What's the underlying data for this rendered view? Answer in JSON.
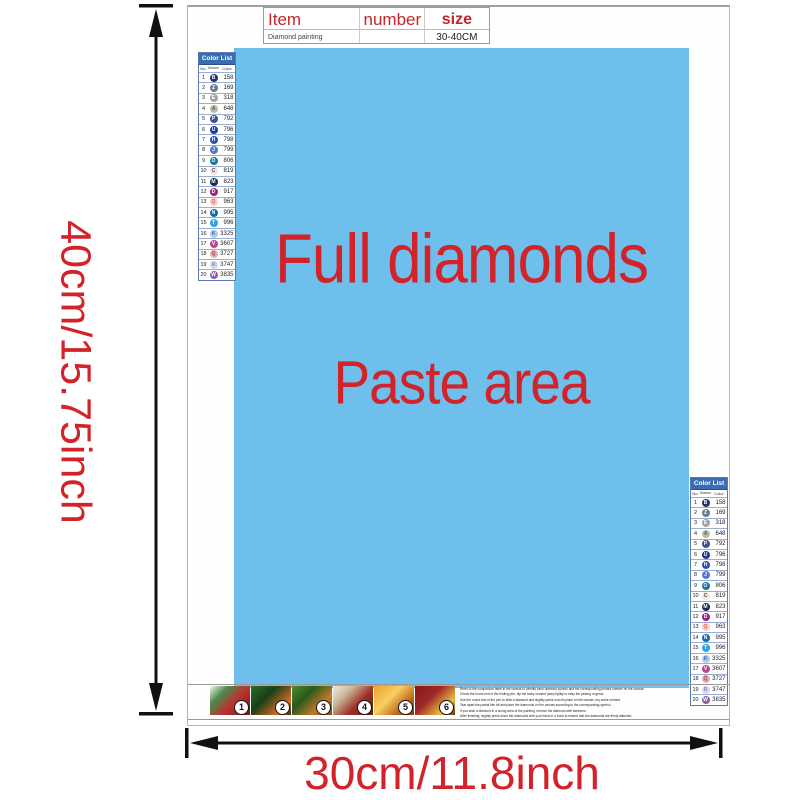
{
  "colors": {
    "accent_red": "#d2232a",
    "paste_blue": "#6fbfec",
    "table_header_blue": "#3a6cb4"
  },
  "dimensions": {
    "height_label": "40cm/15.75inch",
    "width_label": "30cm/11.8inch"
  },
  "spec_table": {
    "headers": [
      "Item",
      "number",
      "size"
    ],
    "row": {
      "item": "Diamond painting",
      "number": "",
      "size": "30-40CM"
    }
  },
  "paste_area": {
    "line1": "Full diamonds",
    "line2": "Paste area"
  },
  "color_list": {
    "title": "Color List",
    "columns": [
      "No.",
      "Diamond",
      "Color"
    ],
    "rows": [
      {
        "no": "1",
        "symbol": "B",
        "code": "158",
        "bg": "#2a2f68",
        "fg": "#ffffff"
      },
      {
        "no": "2",
        "symbol": "Z",
        "code": "169",
        "bg": "#6b7b8c",
        "fg": "#ffffff"
      },
      {
        "no": "3",
        "symbol": "E",
        "code": "318",
        "bg": "#a2a2a2",
        "fg": "#ffffff"
      },
      {
        "no": "4",
        "symbol": "4",
        "code": "648",
        "bg": "#beb8a8",
        "fg": "#555555"
      },
      {
        "no": "5",
        "symbol": "P",
        "code": "792",
        "bg": "#3d4e91",
        "fg": "#ffffff"
      },
      {
        "no": "6",
        "symbol": "U",
        "code": "796",
        "bg": "#21399b",
        "fg": "#ffffff"
      },
      {
        "no": "7",
        "symbol": "H",
        "code": "798",
        "bg": "#2c52b0",
        "fg": "#ffffff"
      },
      {
        "no": "8",
        "symbol": "J",
        "code": "799",
        "bg": "#5677c9",
        "fg": "#ffffff"
      },
      {
        "no": "9",
        "symbol": "O",
        "code": "806",
        "bg": "#1378a0",
        "fg": "#ffffff"
      },
      {
        "no": "10",
        "symbol": "C",
        "code": "819",
        "bg": "#f6e3e0",
        "fg": "#555555"
      },
      {
        "no": "11",
        "symbol": "M",
        "code": "823",
        "bg": "#1a2a52",
        "fg": "#ffffff"
      },
      {
        "no": "12",
        "symbol": "D",
        "code": "917",
        "bg": "#9e2283",
        "fg": "#ffffff"
      },
      {
        "no": "13",
        "symbol": "Q",
        "code": "963",
        "bg": "#f6cfc9",
        "fg": "#d2704f"
      },
      {
        "no": "14",
        "symbol": "N",
        "code": "995",
        "bg": "#0a6cb5",
        "fg": "#ffffff"
      },
      {
        "no": "15",
        "symbol": "T",
        "code": "996",
        "bg": "#2fa3e0",
        "fg": "#ffffff"
      },
      {
        "no": "16",
        "symbol": "K",
        "code": "3325",
        "bg": "#aecbe8",
        "fg": "#3a6fb0"
      },
      {
        "no": "17",
        "symbol": "V",
        "code": "3607",
        "bg": "#bd4594",
        "fg": "#ffffff"
      },
      {
        "no": "18",
        "symbol": "Q",
        "code": "3727",
        "bg": "#ddb0ba",
        "fg": "#b04040"
      },
      {
        "no": "19",
        "symbol": "R",
        "code": "3747",
        "bg": "#d7d5ee",
        "fg": "#8a8ab0"
      },
      {
        "no": "20",
        "symbol": "W",
        "code": "3835",
        "bg": "#8a62a0",
        "fg": "#ffffff"
      }
    ]
  },
  "steps": [
    {
      "n": "1"
    },
    {
      "n": "2"
    },
    {
      "n": "3"
    },
    {
      "n": "4"
    },
    {
      "n": "5"
    },
    {
      "n": "6"
    }
  ],
  "instructions": {
    "lines": [
      "Refer to the comparison table in the canvas to identify each diamond symbol and the corresponding printed number on the canvas.",
      "Check the round end of the finding pen, dip the tacky cement (wax) lightly to easy the picking of gems.",
      "Use the round end of the pen to stick a diamond and slightly press onto its place on the canvas, dry some cement.",
      "Tear apart the partial film bit and place the diamonds on the canvas according to the corresponding symbol.",
      "If you stick a diamond in a wrong area of the painting, remove the diamond with tweezers.",
      "After finishing, slightly press down the diamonds with your hand or a book to ensure that the diamonds are firmly attached."
    ]
  }
}
